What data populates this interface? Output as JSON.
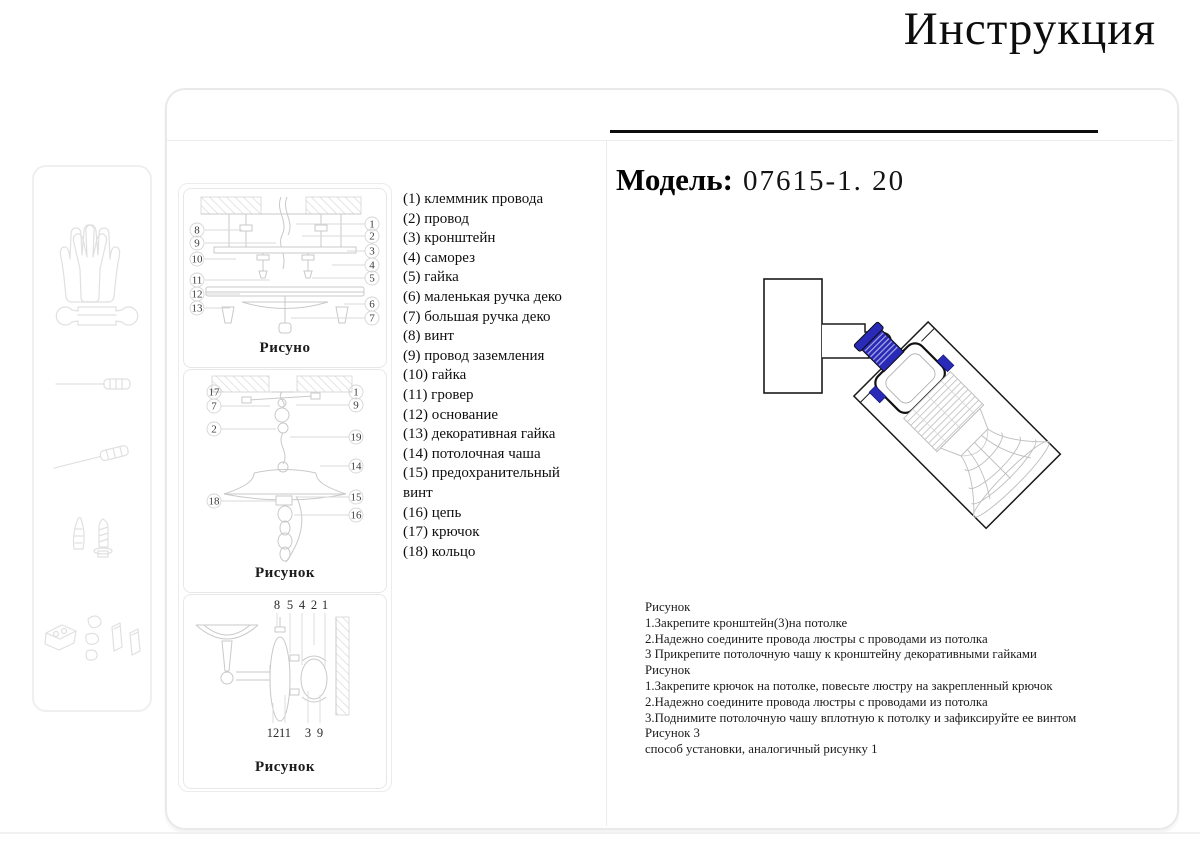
{
  "title": "Инструкция",
  "model": {
    "label": "Модель:",
    "value": "07615-1. 20"
  },
  "sidebar": {
    "icons": [
      "gloves-icon",
      "wrench-icon",
      "screwdriver-icon",
      "screwdriver-angled-icon",
      "screw-anchor-icon",
      "hardware-parts-icon"
    ]
  },
  "figures": {
    "fig1": {
      "caption": "Рисуно",
      "left_labels": [
        "8",
        "9",
        "10",
        "11",
        "12",
        "13"
      ],
      "right_labels": [
        "1",
        "2",
        "3",
        "4",
        "5",
        "6",
        "7"
      ]
    },
    "fig2": {
      "caption": "Рисунок",
      "left_labels": [
        "17",
        "7",
        "2",
        "18"
      ],
      "right_labels": [
        "1",
        "9",
        "19",
        "14",
        "15",
        "16"
      ]
    },
    "fig3": {
      "caption": "Рисунок",
      "top_labels": [
        "8",
        "5",
        "4",
        "2",
        "1"
      ],
      "bottom_labels": [
        "12",
        "11",
        "3",
        "9"
      ]
    }
  },
  "parts": {
    "items": [
      "(1) клеммник провода",
      "(2) провод",
      "(3) кронштейн",
      "(4) саморез",
      "(5) гайка",
      "(6) маленькая ручка деко",
      "(7) большая ручка деко",
      "(8) винт",
      "(9) провод заземления",
      "(10) гайка",
      "(11) гровер",
      "(12) основание",
      "(13) декоративная гайка",
      "(14) потолочная чаша",
      "(15) предохранительный винт",
      "(16) цепь",
      "(17) крючок",
      "(18) кольцо"
    ]
  },
  "drawing": {
    "highlight_color": "#2a2ab8"
  },
  "instructions": {
    "lines": [
      "Рисунок",
      "1.Закрепите кронштейн(3)на потолке",
      "2.Надежно соедините провода люстры с проводами из потолка",
      "3 Прикрепите потолочную чашу к кронштейну декоративными гайками",
      "Рисунок",
      "1.Закрепите крючок на потолке, повесьте люстру на закрепленный крючок",
      "2.Надежно соедините провода люстры с проводами из потолка",
      "3.Поднимите потолочную чашу вплотную к потолку и зафиксируйте ее винтом",
      "Рисунок 3",
      "способ установки,  аналогичный рисунку 1"
    ]
  }
}
